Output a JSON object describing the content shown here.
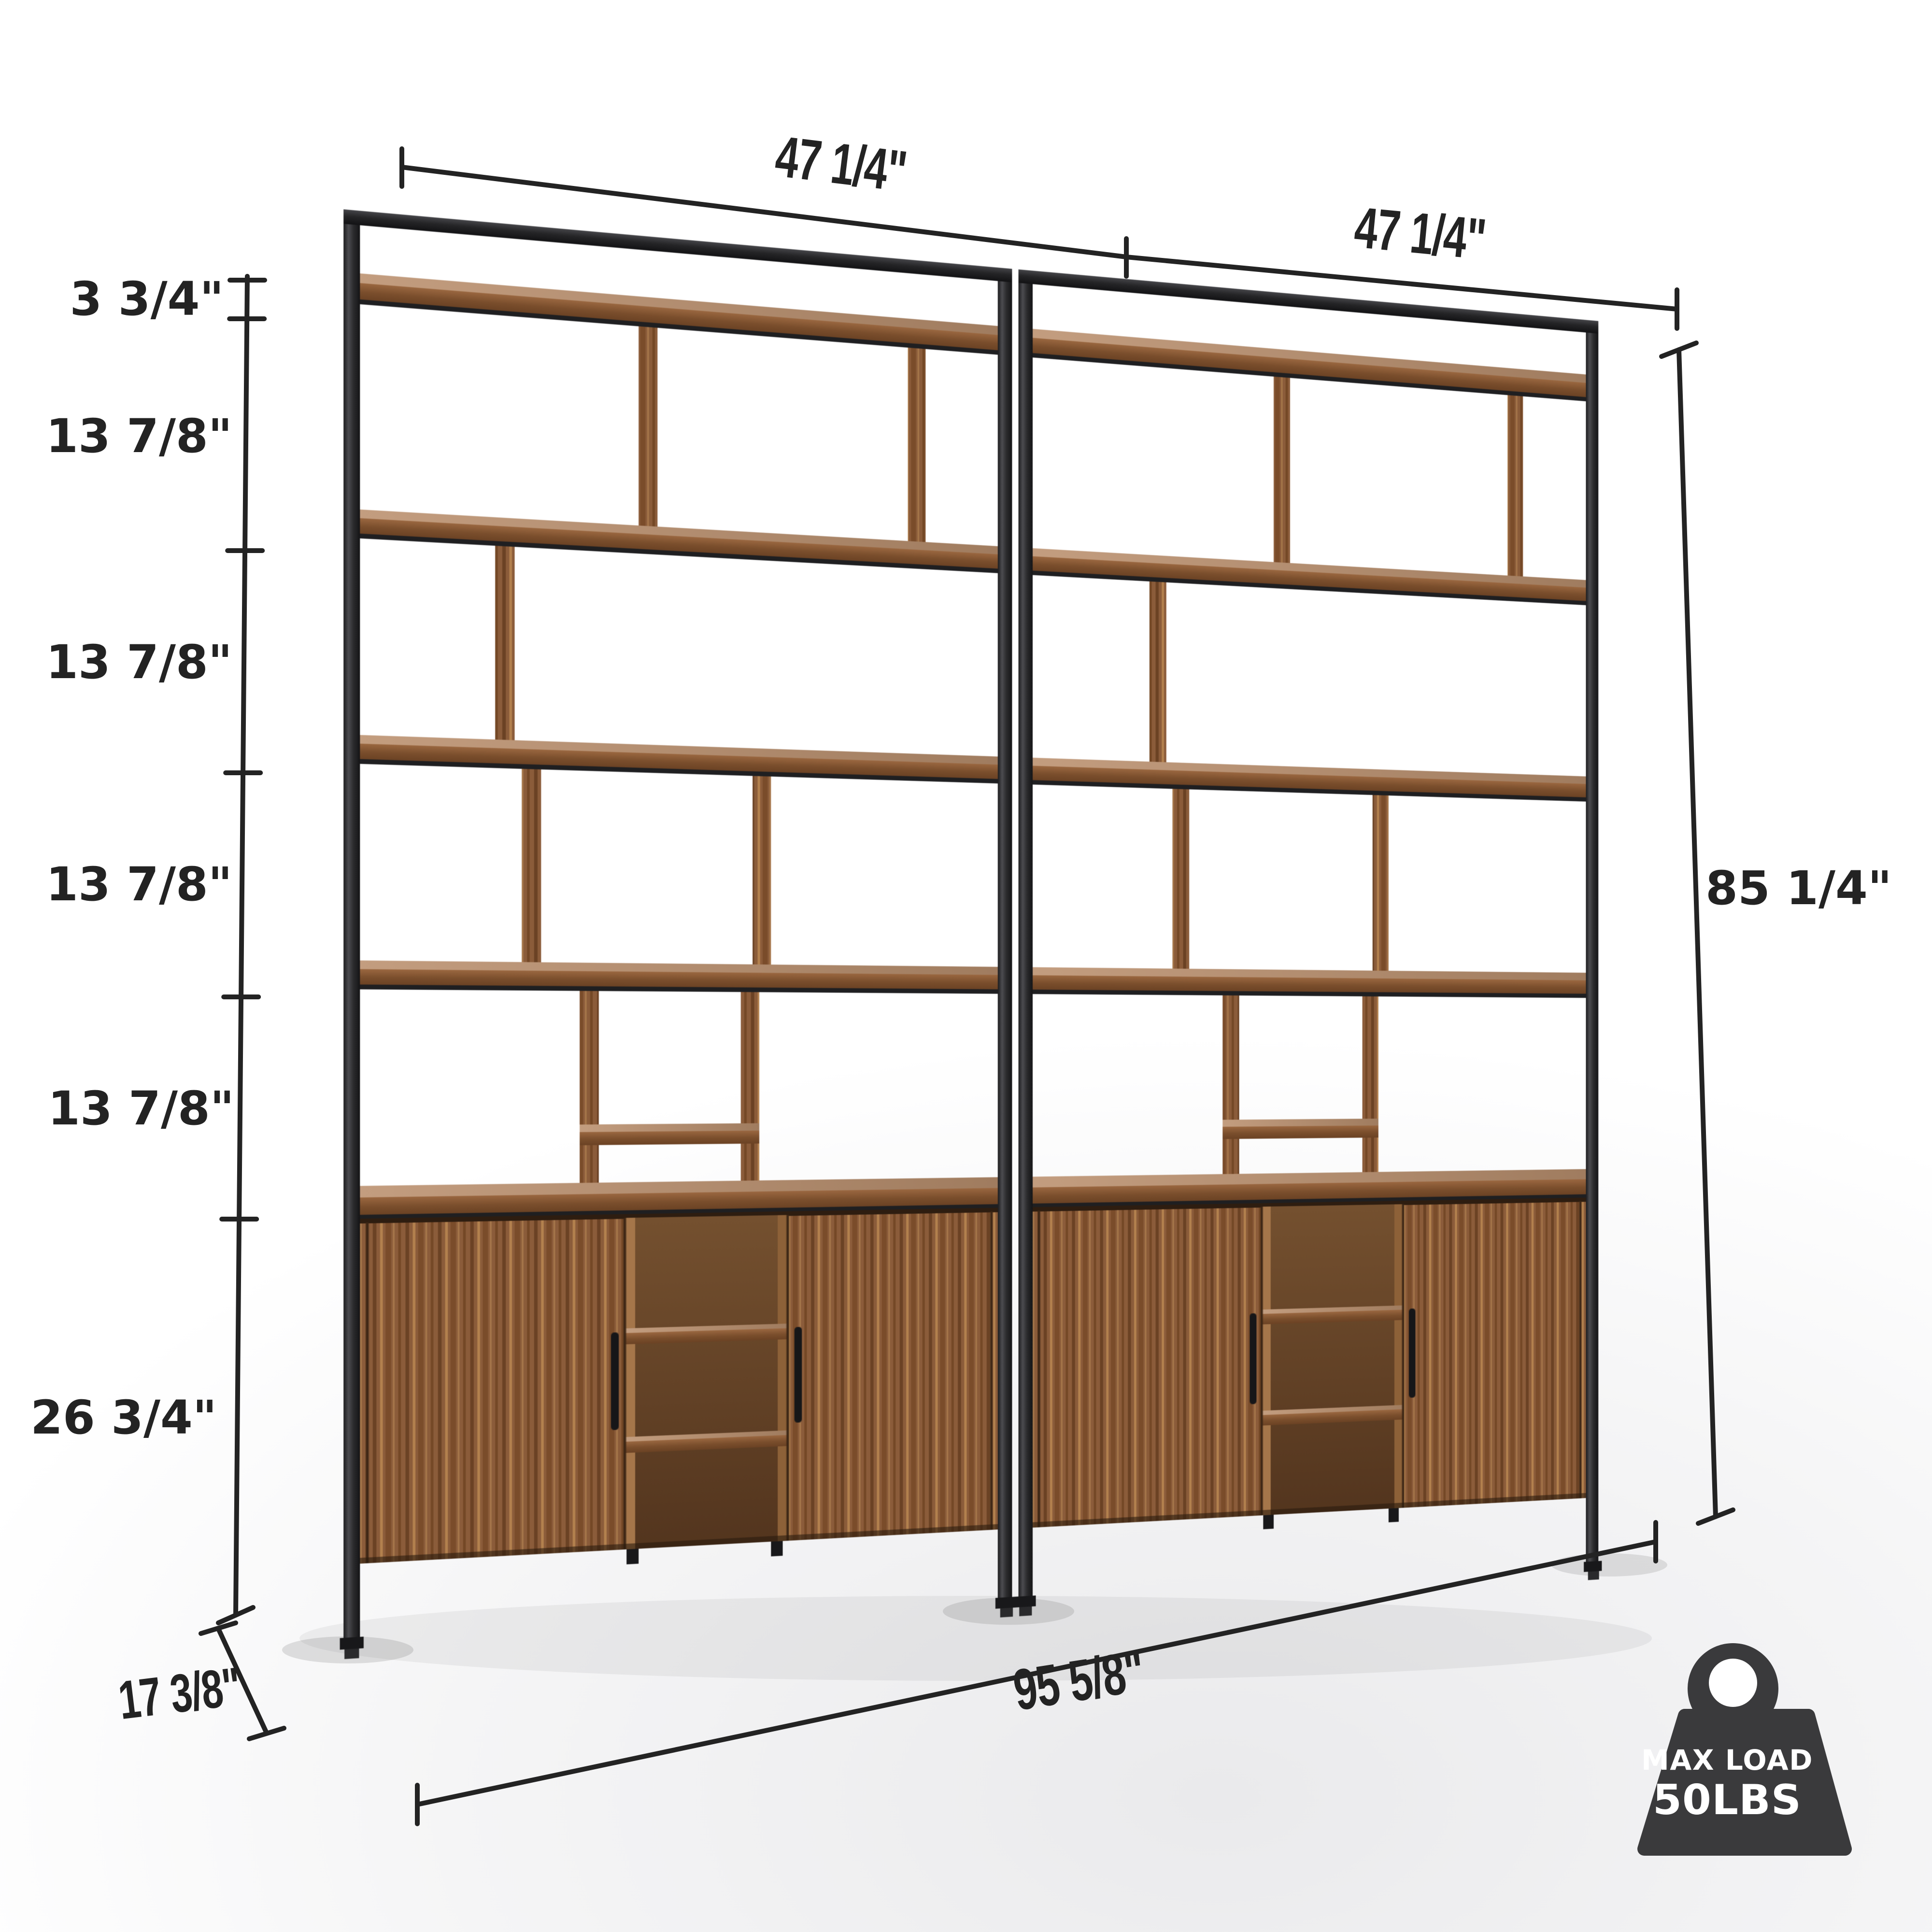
{
  "meta": {
    "type": "furniture-dimension-diagram",
    "subject": "double wide industrial bookshelf with cabinets",
    "background_color": "#ffffff"
  },
  "dimensions": {
    "top_width_left": "47 1/4\"",
    "top_width_right": "47 1/4\"",
    "left_column": {
      "segments": [
        "3 3/4\"",
        "13 7/8\"",
        "13 7/8\"",
        "13 7/8\"",
        "13 7/8\"",
        "26 3/4\""
      ]
    },
    "overall_height": "85 1/4\"",
    "overall_width": "95 5/8\"",
    "depth": "17 3/8\""
  },
  "load_badge": {
    "icon": "weight-icon",
    "title": "MAX LOAD",
    "value": "50LBS",
    "badge_color": "#3a3a3c",
    "text_color": "#ffffff"
  },
  "colors": {
    "dimension_line": "#232323",
    "metal_frame": "#2d2d2f",
    "wood_door": "#8b5c3a",
    "wood_shelf_edge": "#7e5130",
    "wood_shelf_top": "#b08a6d",
    "wood_interior": "#5f3d26"
  }
}
